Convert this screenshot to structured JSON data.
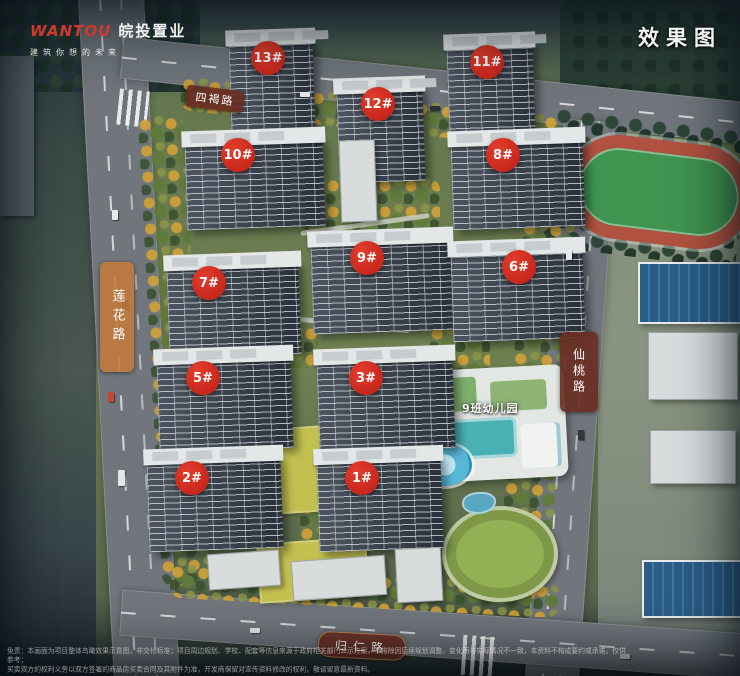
{
  "header": {
    "logo": {
      "brand_en": "WANTOU",
      "brand_cn": "皖投置业",
      "tagline": "建筑你想的未来"
    },
    "watermark": "效果图"
  },
  "roads": {
    "top": "四褐路",
    "left": "莲花路",
    "right": "仙桃路",
    "bottom": "归仁路"
  },
  "markers": [
    {
      "label": "13#"
    },
    {
      "label": "12#"
    },
    {
      "label": "11#"
    },
    {
      "label": "10#"
    },
    {
      "label": "8#"
    },
    {
      "label": "9#"
    },
    {
      "label": "6#"
    },
    {
      "label": "7#"
    },
    {
      "label": "5#"
    },
    {
      "label": "3#"
    },
    {
      "label": "2#"
    },
    {
      "label": "1#"
    }
  ],
  "facilities": {
    "kindergarten": "9班幼儿园"
  },
  "disclaimer": {
    "line1": "免责：本画面为项目整体鸟瞰效果示意图，非交付标准；项目周边规划、学校、配套等信息来源于政府相关部门公示方案，不排除因后续规划调整、变化而与实际情况不一致，本资料不构成要约或承诺，仅供参考；",
    "line2": "买卖双方的权利义务以双方签署的商品房买卖合同及其附件为准，开发商保留对宣传资料修改的权利，敬请留意最新资料。"
  },
  "colors": {
    "marker_red": "#c92318",
    "road_label_maroon": "#6a2f23",
    "road_label_orange": "#c17b3a",
    "brand_red": "#cf3a2e"
  }
}
